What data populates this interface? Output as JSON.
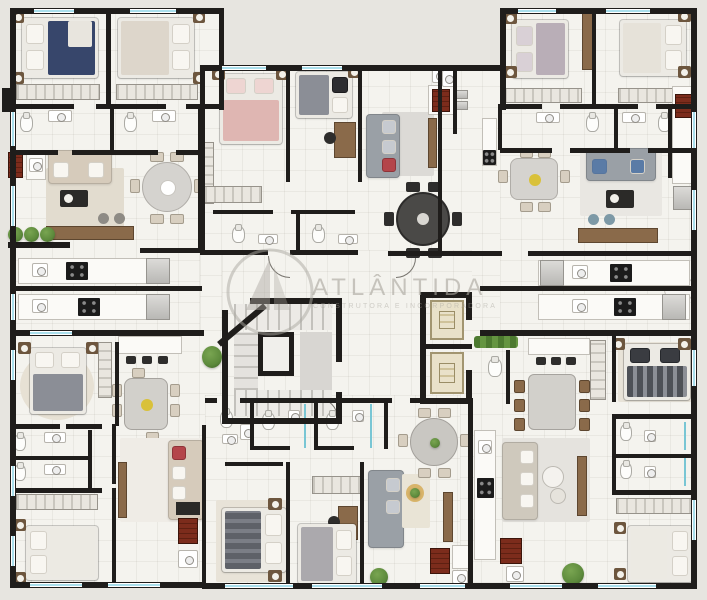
{
  "watermark": {
    "title": "ATLÂNTIDA",
    "subtitle": "CONSTRUTORA E INCORPORADORA",
    "logo": "atlantida-sail-circle-logo"
  },
  "palette": {
    "exterior": "#e7e5e0",
    "floor": "#f4f3ee",
    "grid": "rgba(140,133,120,0.10)",
    "wall": "#1f1d1b",
    "window": "#aadfec",
    "wood": "#8a6a4a",
    "stoveRed": "#7c2c1c",
    "sofaBeige": "#d6cbbb",
    "sofaGray": "#9aa0a6",
    "rug": "#e2dccf",
    "plant": "#5d8a3c",
    "elevator": "#e9e1c9",
    "watermark": "#aaa79f",
    "bedNavy": "#37466b",
    "bedPink": "#dfb6b2",
    "bedGray": "#8b8e96",
    "bedDark": "#5e6168",
    "bedLilac": "#b9aeb7"
  },
  "plan": {
    "type": "residential-floor-plan",
    "core": [
      "staircase",
      "elevator-1",
      "elevator-2",
      "hall",
      "service-wc",
      "planter-hedge"
    ],
    "units": [
      {
        "id": "top-left",
        "rooms": [
          "bedroom-navy",
          "bedroom-white",
          "bath-1",
          "bath-2",
          "living",
          "dining",
          "kitchen",
          "bbq-terrace"
        ]
      },
      {
        "id": "top-middle",
        "rooms": [
          "bedroom-pink",
          "bedroom-gray-desk",
          "bath-1",
          "bath-2",
          "living",
          "dining",
          "kitchen"
        ]
      },
      {
        "id": "top-right",
        "rooms": [
          "bedroom-lilac",
          "bedroom-white",
          "bath-1",
          "bath-2",
          "living",
          "dining",
          "kitchen",
          "laundry"
        ]
      },
      {
        "id": "bottom-left",
        "rooms": [
          "bedroom-gray",
          "bedroom-white",
          "bath-1",
          "bath-2",
          "living",
          "dining",
          "kitchen-island"
        ]
      },
      {
        "id": "bottom-middle",
        "rooms": [
          "bedroom-dark",
          "bedroom-light-desk",
          "bath-1",
          "bath-2",
          "wc",
          "living",
          "dining",
          "kitchen"
        ]
      },
      {
        "id": "bottom-right",
        "rooms": [
          "bedroom-dark",
          "bedroom-white",
          "bath-1",
          "bath-2",
          "living",
          "dining",
          "kitchen-island"
        ]
      }
    ]
  }
}
